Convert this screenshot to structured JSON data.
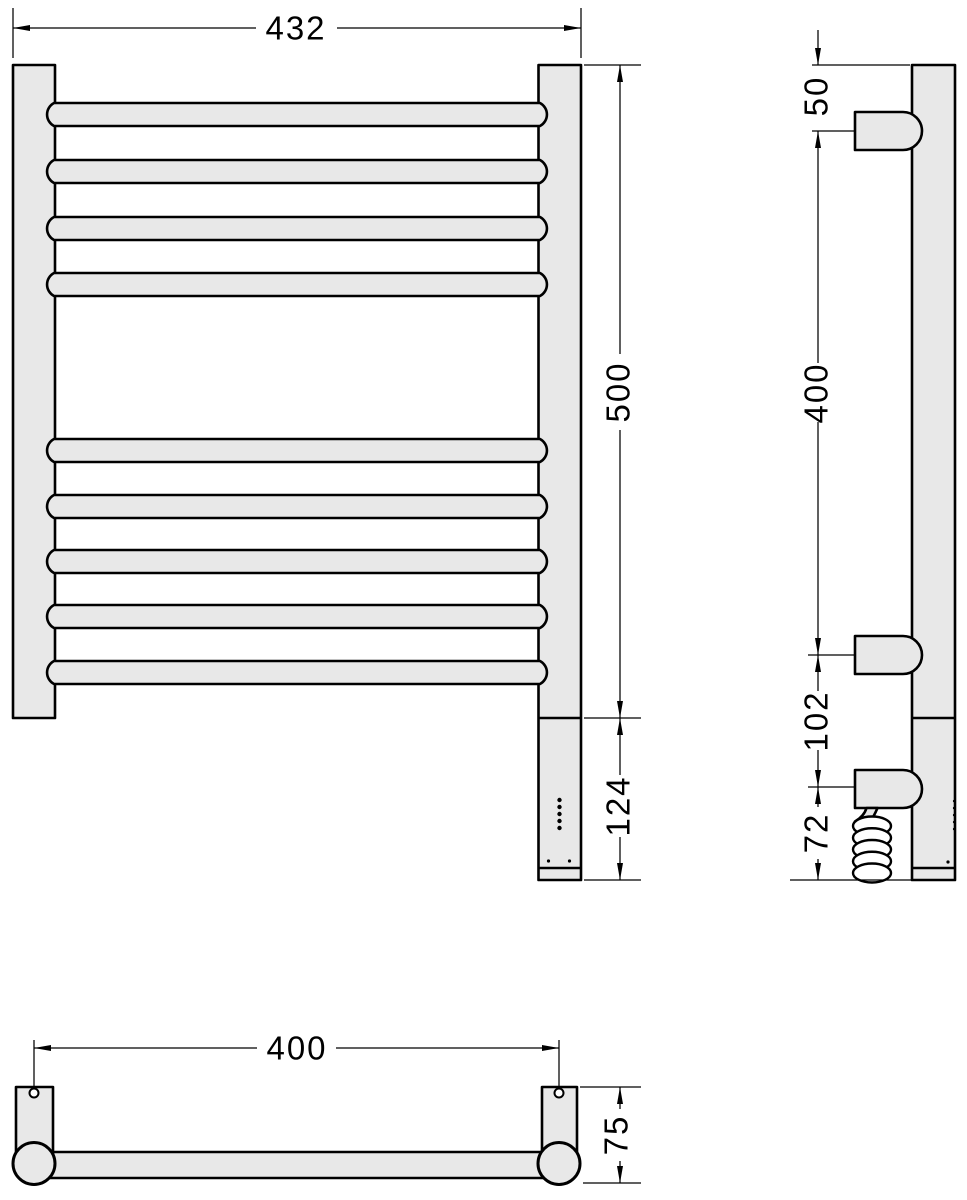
{
  "document": {
    "type": "technical-drawing",
    "subject": "electric heated towel rail with three orthographic views and dimension annotations",
    "units_shown": "mm"
  },
  "colors": {
    "background": "#ffffff",
    "outline": "#000000",
    "part_fill": "#e8e8e8"
  },
  "views": {
    "front": {
      "dimensions": {
        "width": "432",
        "height": "500",
        "heater_section": "124"
      },
      "bars": {
        "count": 9,
        "centers_y": [
          114.5,
          171.5,
          228.5,
          284.5,
          450.5,
          506.5,
          561.5,
          616.5,
          672.5
        ]
      },
      "indicator_dots": {
        "count": 5
      },
      "bottom_dot_count": 2
    },
    "side": {
      "dimensions": {
        "bracket_top_offset": "50",
        "bracket_span": "400",
        "connector_offset": "102",
        "cable_drop": "72"
      },
      "coil_turns": 5,
      "edge_tick_count": 5
    },
    "bottom": {
      "dimensions": {
        "mount_spacing": "400",
        "depth": "75"
      }
    }
  }
}
